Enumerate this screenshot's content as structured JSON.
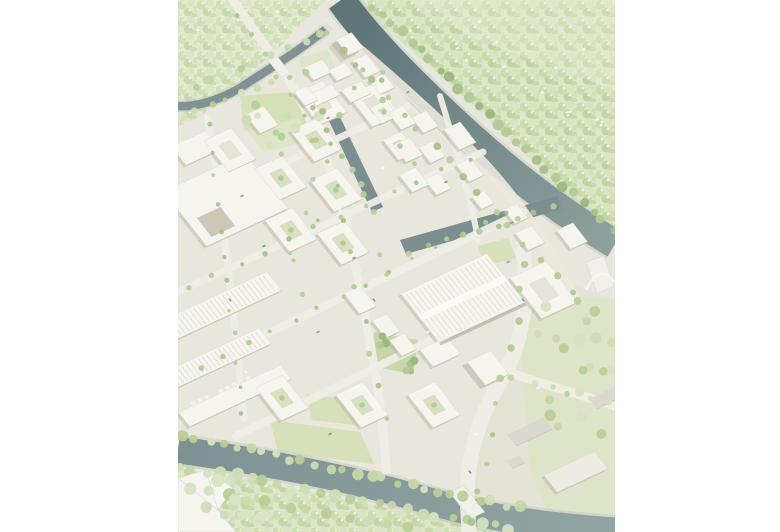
{
  "figure": {
    "kind": "architectural-aerial-render",
    "description": "Bird's-eye architectural rendering of a riverside urban masterplan: white perimeter-block buildings with green courtyards, a large sawtooth-roof industrial hall, tree-lined streets, a canal basin, two rivers with bridges, and dense pale-green forest to the north and south",
    "orientation": "portrait"
  },
  "palette": {
    "page_bg": "#ffffff",
    "ground": "#e9e6dd",
    "rural": "#e5e3d6",
    "street": "#efede6",
    "esplanade": "#ebe8de",
    "building": "#f6f4ee",
    "building_stroke": "#d9d3c6",
    "building_edge": "#c9c2b2",
    "shadow": "#b3ab9a",
    "notch": "#cdc7b8",
    "gray_roof": "#dbd8cf",
    "gray_light": "#edebe4",
    "hall_stripe": "#d8d3c6",
    "hall_spine": "#fbfaf6",
    "deck": "#f0efe9",
    "deck_edge": "#d8d6cc",
    "forest": "#dde6c9",
    "forest_light": "#e3ebd3",
    "lawn": "#d6e0b9",
    "lawn_light": "#dde6c6",
    "yard": "#dde4c8",
    "water_dark": "#5e7678",
    "water_mid": "#7b9093",
    "water_light": "#93a5a2",
    "water_edge": "#c2ccc0",
    "canal": "#7b8f91",
    "plaza_tile": "#f4f2ec",
    "speck": "#fbfaf7",
    "trees_green": [
      "#c6d7a8",
      "#cfdcb4",
      "#b9cf97",
      "#d6e2c2"
    ],
    "trees_dark": [
      "#a7c189",
      "#9bb77e",
      "#b3ca94"
    ],
    "trees_street": [
      "#b4ca92",
      "#a9c288",
      "#bccf9a"
    ],
    "trees_light": [
      "#d8e3c4",
      "#cfdcba",
      "#e0e9cf"
    ],
    "car_colors": [
      "#9aa1a5",
      "#f8f8f6",
      "#8d9398"
    ]
  },
  "scene": {
    "features": [
      {
        "name": "forest-north",
        "label": "Forest north of river"
      },
      {
        "name": "forest-northwest",
        "label": "Forest at top left"
      },
      {
        "name": "forest-south-bank",
        "label": "Wooded south river bank"
      },
      {
        "name": "main-river",
        "label": "Main river"
      },
      {
        "name": "west-river-arm",
        "label": "West river arm"
      },
      {
        "name": "south-river",
        "label": "South river"
      },
      {
        "name": "canal-basin",
        "label": "Canal and harbour basin"
      },
      {
        "name": "north-bridge",
        "label": "North road bridge"
      },
      {
        "name": "south-bridge",
        "label": "South road bridge"
      },
      {
        "name": "arch-bridge",
        "label": "Arch footbridge"
      },
      {
        "name": "residential-blocks",
        "label": "Perimeter housing blocks with courtyards"
      },
      {
        "name": "high-rise-tower",
        "label": "High-rise tower at river bend"
      },
      {
        "name": "sawtooth-hall",
        "label": "Large sawtooth-roof industrial hall"
      },
      {
        "name": "industrial-halls",
        "label": "Existing industrial halls (west)"
      },
      {
        "name": "checkerboard-plaza",
        "label": "Checkerboard plaza"
      },
      {
        "name": "park-lawns",
        "label": "Park lawns"
      },
      {
        "name": "existing-buildings-southeast",
        "label": "Existing buildings south-east"
      }
    ]
  }
}
